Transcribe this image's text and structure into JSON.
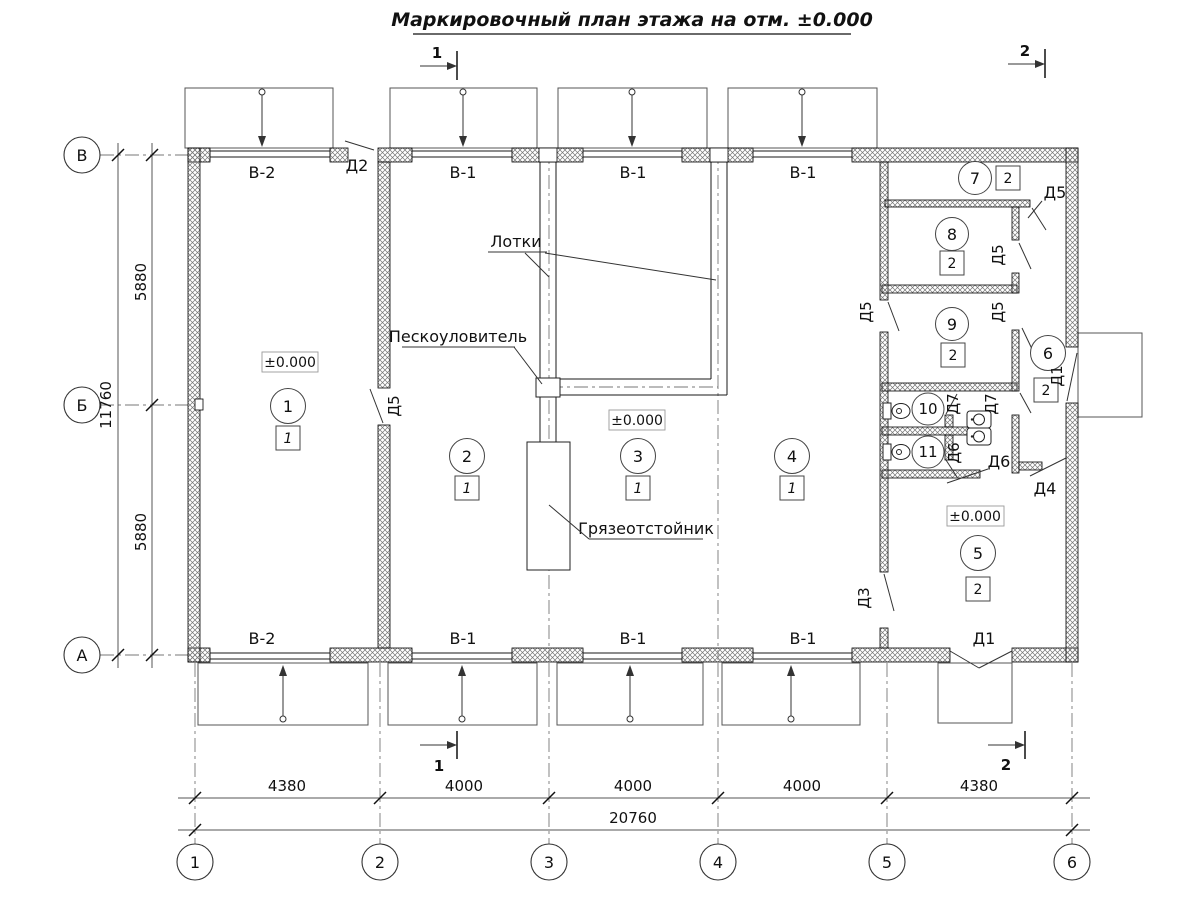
{
  "title": "Маркировочный план этажа на отм. ±0.000",
  "sections": {
    "cut1": "1",
    "cut2": "2"
  },
  "grid": {
    "cols": [
      "1",
      "2",
      "3",
      "4",
      "5",
      "6"
    ],
    "rows": [
      "В",
      "Б",
      "А"
    ]
  },
  "dims": {
    "bottom": [
      "4380",
      "4000",
      "4000",
      "4000",
      "4380"
    ],
    "bottom_total": "20760",
    "left": [
      "5880",
      "5880"
    ],
    "left_total": "11760"
  },
  "windows": {
    "top": [
      "В-2",
      "В-1",
      "В-1",
      "В-1"
    ],
    "bottom": [
      "В-2",
      "В-1",
      "В-1",
      "В-1"
    ]
  },
  "doors": {
    "d1": "Д1",
    "d2": "Д2",
    "d3": "Д3",
    "d4": "Д4",
    "d5": "Д5",
    "d6": "Д6",
    "d7": "Д7"
  },
  "rooms": [
    {
      "number": "1",
      "category": "1",
      "elevation": "±0.000"
    },
    {
      "number": "2",
      "category": "1"
    },
    {
      "number": "3",
      "category": "1",
      "elevation": "±0.000"
    },
    {
      "number": "4",
      "category": "1"
    },
    {
      "number": "5",
      "category": "2",
      "elevation": "±0.000"
    },
    {
      "number": "6",
      "category": "2"
    },
    {
      "number": "7",
      "category": "2"
    },
    {
      "number": "8",
      "category": "2"
    },
    {
      "number": "9",
      "category": "2"
    },
    {
      "number": "10"
    },
    {
      "number": "11"
    }
  ],
  "annotations": {
    "trays": "Лотки",
    "sand_trap": "Пескоуловитель",
    "mud_settler": "Грязеотстойник"
  }
}
